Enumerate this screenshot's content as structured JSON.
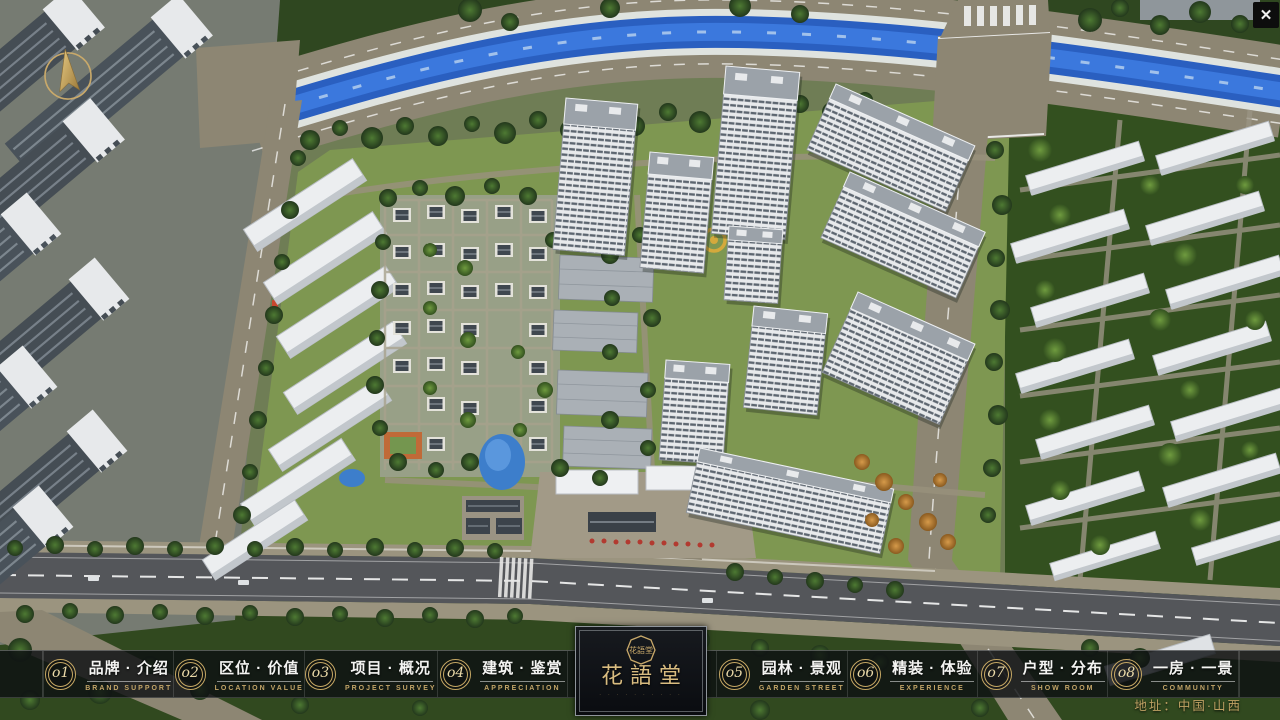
{
  "window": {
    "close_glyph": "✕"
  },
  "nav": {
    "items": [
      {
        "num": "o1",
        "zh": "品牌 · 介绍",
        "en": "BRAND SUPPORT"
      },
      {
        "num": "o2",
        "zh": "区位 · 价值",
        "en": "LOCATION VALUE"
      },
      {
        "num": "o3",
        "zh": "项目 · 概况",
        "en": "PROJECT SURVEY"
      },
      {
        "num": "o4",
        "zh": "建筑 · 鉴赏",
        "en": "APPRECIATION"
      },
      {
        "num": "o5",
        "zh": "园林 · 景观",
        "en": "GARDEN STREET"
      },
      {
        "num": "o6",
        "zh": "精装 · 体验",
        "en": "EXPERIENCE"
      },
      {
        "num": "o7",
        "zh": "户型 · 分布",
        "en": "SHOW ROOM"
      },
      {
        "num": "o8",
        "zh": "一房 · 一景",
        "en": "COMMUNITY"
      }
    ]
  },
  "logo": {
    "seal": "花語堂",
    "name": "花語堂",
    "subtext": "· · · · · · · · · ·"
  },
  "footer": {
    "address": "地址：中国·山西"
  },
  "colors": {
    "gold": "#c2a467",
    "bar_bg": "rgba(14,16,18,0.82)",
    "river": "#2e66cc",
    "lawn": "#7e9751"
  }
}
